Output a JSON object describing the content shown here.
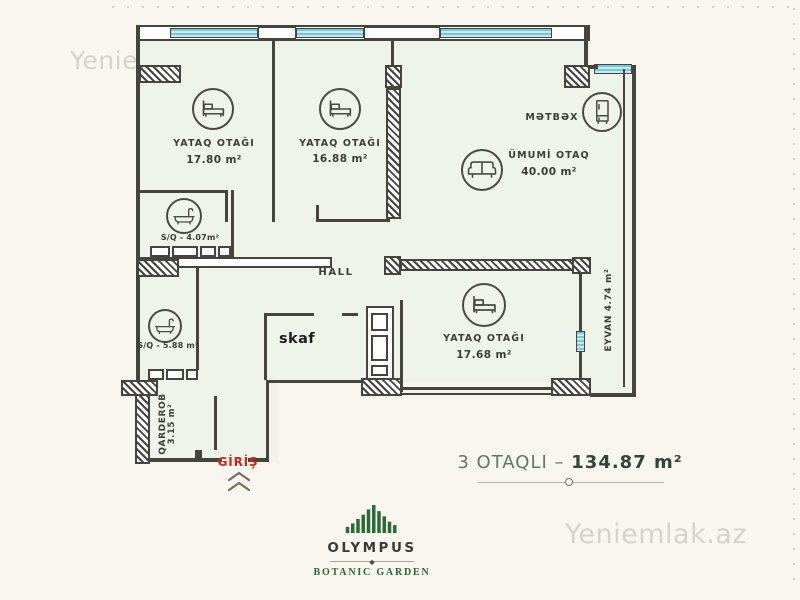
{
  "watermarks": {
    "top_left": "Yeniemlak.az",
    "center": "Yeniemlak.az",
    "bottom_right": "Yeniemlak.az"
  },
  "plan": {
    "rooms": {
      "bedroom1": {
        "name": "YATAQ OTAĞI",
        "area": "17.80 m²"
      },
      "bedroom2": {
        "name": "YATAQ OTAĞI",
        "area": "16.88 m²"
      },
      "bedroom3": {
        "name": "YATAQ OTAĞI",
        "area": "17.68 m²"
      },
      "living_room": {
        "name": "ÜMUMİ OTAQ",
        "area": "40.00 m²"
      },
      "kitchen": {
        "name": "MƏTBƏX"
      },
      "bathroom_small": {
        "name": "S/Q -",
        "area": "4.07m²"
      },
      "bathroom_large": {
        "name": "S/Q -",
        "area": "5.88 m²"
      },
      "hall": {
        "name": "HALL"
      },
      "closet": {
        "name": "skaf"
      },
      "balcony": {
        "name": "EYVAN 4.74 m²"
      },
      "wardrobe": {
        "name": "QARDEROB",
        "area": "3.15 m²"
      },
      "entrance": {
        "name": "GİRİŞ"
      }
    }
  },
  "summary": {
    "label": "3 OTAQLI –",
    "area": "134.87 m²"
  },
  "branding": {
    "title": "OLYMPUS",
    "subtitle": "BOTANIC GARDEN"
  },
  "colors": {
    "background": "#f8f6ef",
    "floor": "#eef4e9",
    "wall": "#45453e",
    "window": "#a5d9e6",
    "entrance_red": "#c52a1e",
    "summary_green": "#5c7a64",
    "summary_green_dark": "#2f4639",
    "logo_green": "#2d6a35"
  }
}
